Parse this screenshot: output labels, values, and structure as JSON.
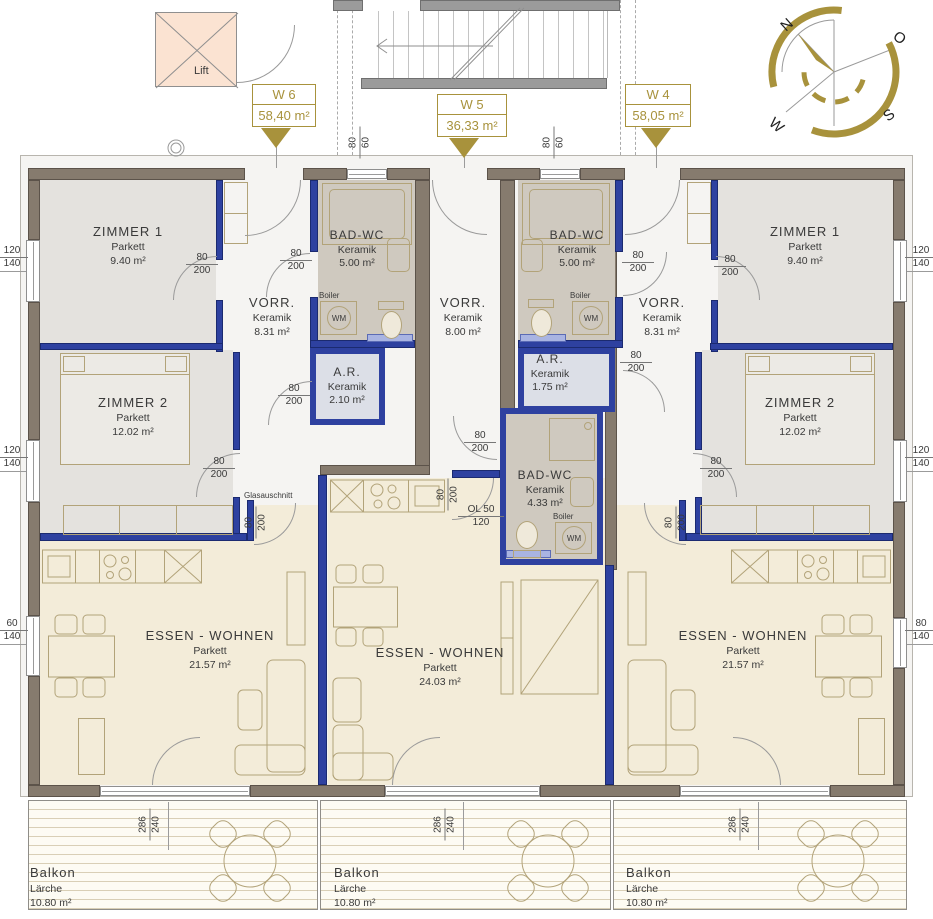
{
  "colors": {
    "gold": "#a8923c",
    "wall_brown": "#867b6e",
    "wall_blue": "#2e41a0",
    "zimmer": "#e4e2de",
    "bad": "#cfc9bf",
    "abstell": "#dcdfe7",
    "vorraum": "#f5f4f2",
    "wohnen": "#f3ecd9",
    "lift": "#fbe3d2",
    "sill": "#a9b4e2"
  },
  "compass": {
    "n": "N",
    "e": "O",
    "s": "S",
    "w": "W"
  },
  "labels": {
    "lift": "Lift",
    "glas": "Glasauschnitt",
    "boiler": "Boiler",
    "wm": "WM"
  },
  "units": [
    {
      "id": "W 6",
      "area": "58,40 m²"
    },
    {
      "id": "W 5",
      "area": "36,33 m²"
    },
    {
      "id": "W 4",
      "area": "58,05 m²"
    }
  ],
  "rooms": [
    {
      "name": "ZIMMER 1",
      "mat": "Parkett",
      "area": "9.40 m²"
    },
    {
      "name": "ZIMMER 2",
      "mat": "Parkett",
      "area": "12.02 m²"
    },
    {
      "name": "VORR.",
      "mat": "Keramik",
      "area": "8.31 m²"
    },
    {
      "name": "BAD-WC",
      "mat": "Keramik",
      "area": "5.00 m²"
    },
    {
      "name": "A.R.",
      "mat": "Keramik",
      "area": "2.10 m²"
    },
    {
      "name": "ESSEN - WOHNEN",
      "mat": "Parkett",
      "area": "21.57 m²"
    },
    {
      "name": "VORR.",
      "mat": "Keramik",
      "area": "8.00 m²"
    },
    {
      "name": "BAD-WC",
      "mat": "Keramik",
      "area": "4.33 m²"
    },
    {
      "name": "ESSEN - WOHNEN",
      "mat": "Parkett",
      "area": "24.03 m²"
    },
    {
      "name": "BAD-WC",
      "mat": "Keramik",
      "area": "5.00 m²"
    },
    {
      "name": "A.R.",
      "mat": "Keramik",
      "area": "1.75 m²"
    },
    {
      "name": "VORR.",
      "mat": "Keramik",
      "area": "8.31 m²"
    },
    {
      "name": "ZIMMER 1",
      "mat": "Parkett",
      "area": "9.40 m²"
    },
    {
      "name": "ZIMMER 2",
      "mat": "Parkett",
      "area": "12.02 m²"
    },
    {
      "name": "ESSEN - WOHNEN",
      "mat": "Parkett",
      "area": "21.57 m²"
    }
  ],
  "balconies": [
    {
      "name": "Balkon",
      "mat": "Lärche",
      "area": "10.80 m²"
    },
    {
      "name": "Balkon",
      "mat": "Lärche",
      "area": "10.80 m²"
    },
    {
      "name": "Balkon",
      "mat": "Lärche",
      "area": "10.80 m²"
    }
  ],
  "dims": {
    "door": {
      "a": "80",
      "b": "200"
    },
    "topwin": {
      "a": "80",
      "b": "60"
    },
    "win120": {
      "a": "120",
      "b": "140"
    },
    "win60": {
      "a": "60",
      "b": "140"
    },
    "win80": {
      "a": "80",
      "b": "140"
    },
    "balc": {
      "a": "286",
      "b": "240"
    },
    "ol": {
      "a": "OL 50",
      "b": "120"
    }
  }
}
